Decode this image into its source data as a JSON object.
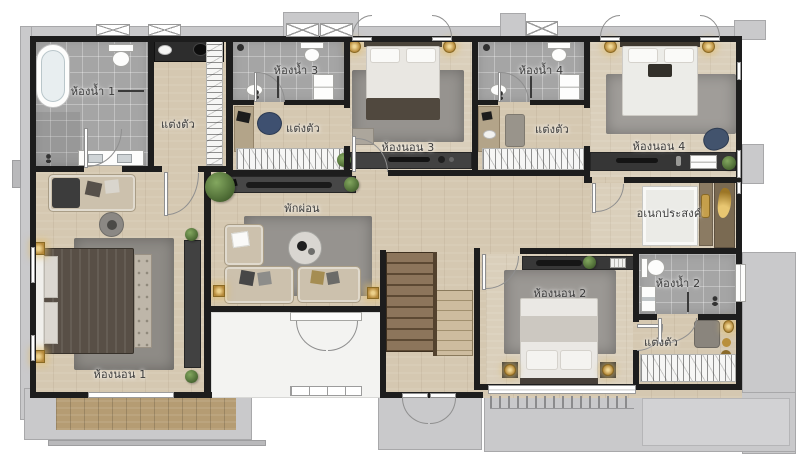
{
  "plan": {
    "rooms": {
      "bathroom1": {
        "label": "ห้องน้ำ 1"
      },
      "bathroom2": {
        "label": "ห้องน้ำ 2"
      },
      "bathroom3": {
        "label": "ห้องน้ำ 3"
      },
      "bathroom4": {
        "label": "ห้องน้ำ 4"
      },
      "bedroom1": {
        "label": "ห้องนอน 1"
      },
      "bedroom2": {
        "label": "ห้องนอน 2"
      },
      "bedroom3": {
        "label": "ห้องนอน 3"
      },
      "bedroom4": {
        "label": "ห้องนอน 4"
      },
      "dressing1": {
        "label": "แต่งตัว"
      },
      "dressing2": {
        "label": "แต่งตัว"
      },
      "dressing3": {
        "label": "แต่งตัว"
      },
      "dressing4": {
        "label": "แต่งตัว"
      },
      "living": {
        "label": "พักผ่อน"
      },
      "multipurpose": {
        "label": "อเนกประสงค์"
      }
    },
    "colors": {
      "wall": "#1d1d1d",
      "wood_floor": "#d5c8b1",
      "tile_floor": "#a5a5a5",
      "concrete": "#c9c9cb",
      "rug": "#96938f",
      "sofa_beige": "#ccc1ad",
      "accent_navy": "#42536d",
      "accent_gold": "#c59f4b",
      "deck_wood": "#b59c73",
      "plant_green": "#5c7d42"
    }
  }
}
